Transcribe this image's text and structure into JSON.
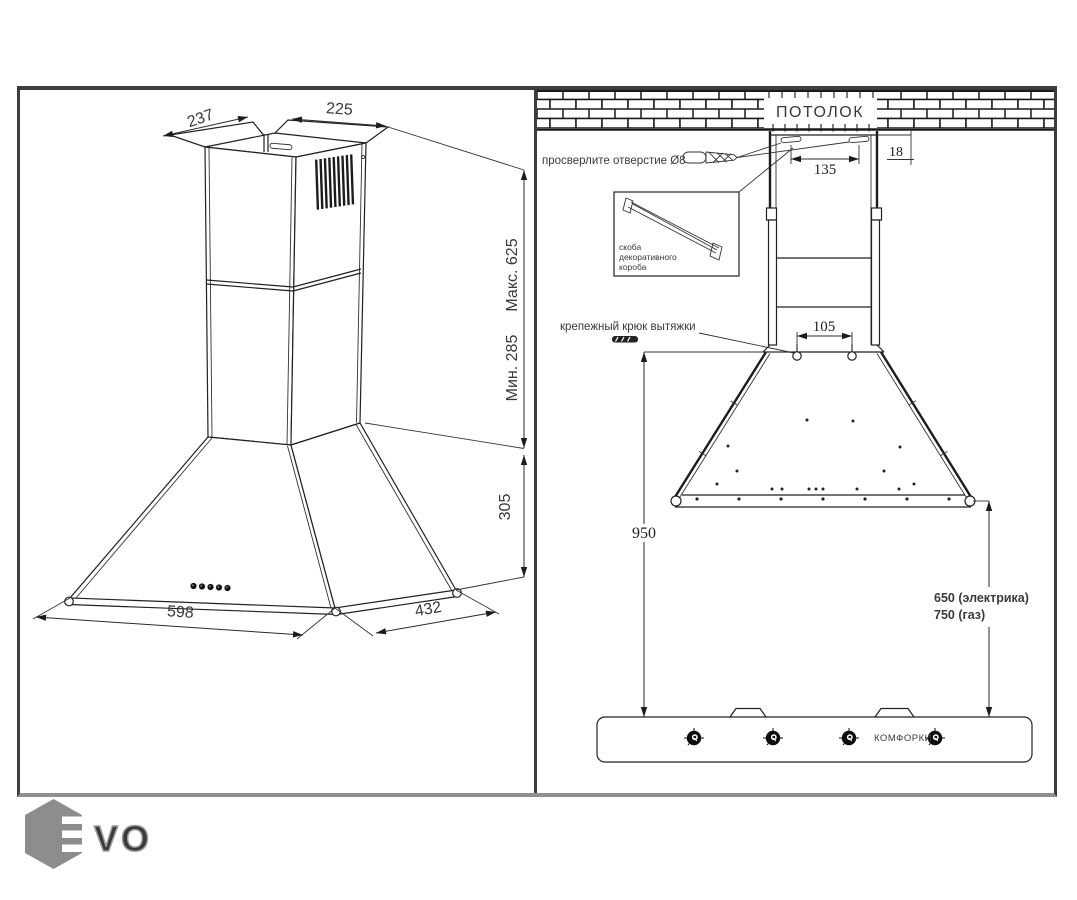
{
  "left_view": {
    "dim_top_depth": "237",
    "dim_top_width": "225",
    "dim_chimney_max": "Макс. 625",
    "dim_chimney_min": "Мин. 285",
    "dim_body_height": "305",
    "dim_body_width": "598",
    "dim_body_depth": "432"
  },
  "right_view": {
    "ceiling": "ПОТОЛОК",
    "drill_note": "просверлите отверстие Ø8",
    "bracket_note": [
      "скоба",
      "декоративного",
      "короба"
    ],
    "hook_note": "крепежный крюк вытяжки",
    "dim_slot_spacing": "135",
    "dim_ceiling_gap": "18",
    "dim_hook_spacing": "105",
    "dim_floor_height": "950",
    "dim_electric": "650 (электрика)",
    "dim_gas": "750 (газ)",
    "burners": "КОМФОРКИ"
  },
  "logo": {
    "letters": "VO",
    "color": "#8d8d8d"
  }
}
